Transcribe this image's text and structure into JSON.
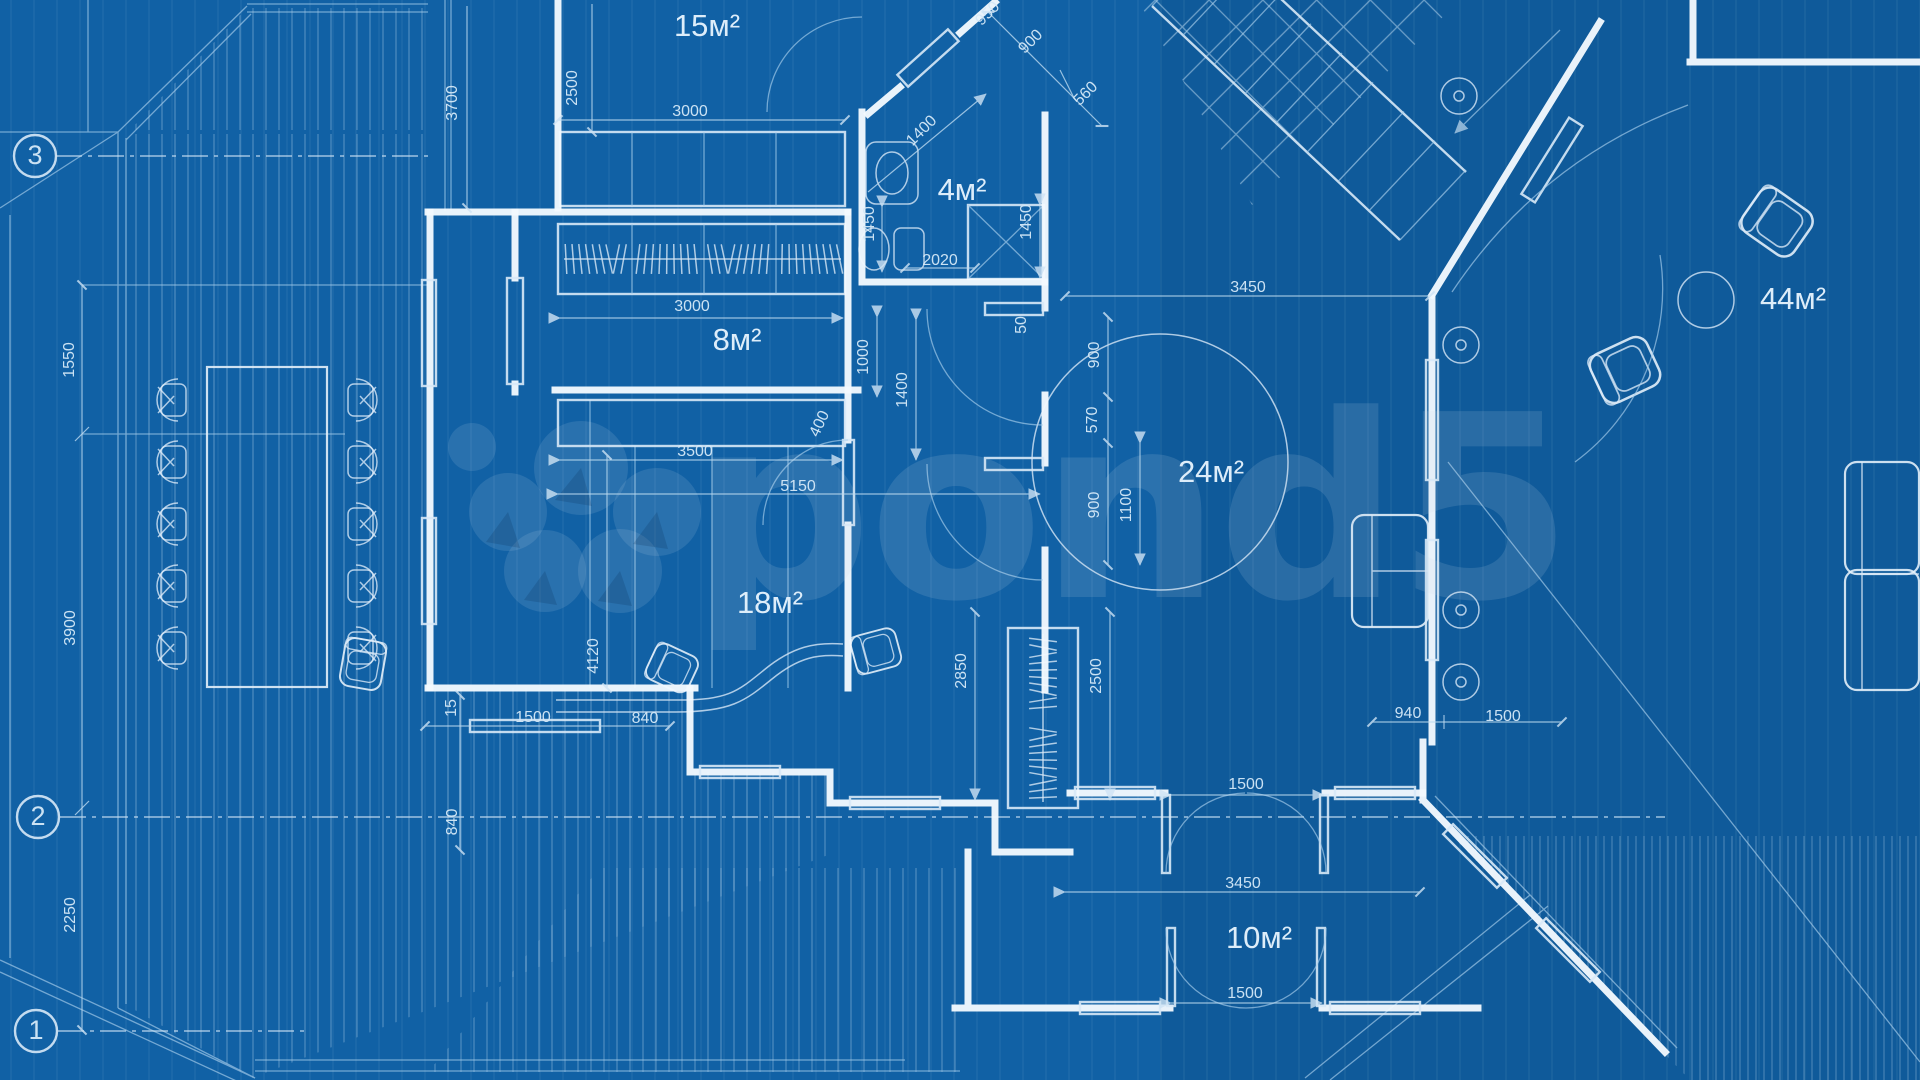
{
  "title": "Architecture blueprint floor plan",
  "colors": {
    "background": "#1161a5",
    "wall_lines": "#f3f9fe",
    "thin_lines": "#a9cfec",
    "labels": "#d5e9f8",
    "watermark": "rgba(208,222,236,0.14)"
  },
  "watermark": {
    "text": "pond5",
    "logo": "pond5-circles-logo"
  },
  "grid_markers": [
    {
      "label": "3",
      "x": 35,
      "y": 156
    },
    {
      "label": "2",
      "x": 38,
      "y": 817
    },
    {
      "label": "1",
      "x": 36,
      "y": 1031
    }
  ],
  "rooms": [
    {
      "label": "15м²",
      "x": 707,
      "y": 28
    },
    {
      "label": "4м²",
      "x": 962,
      "y": 192
    },
    {
      "label": "8м²",
      "x": 737,
      "y": 342
    },
    {
      "label": "24м²",
      "x": 1211,
      "y": 474
    },
    {
      "label": "18м²",
      "x": 770,
      "y": 605
    },
    {
      "label": "10м²",
      "x": 1259,
      "y": 940
    },
    {
      "label": "44м²",
      "x": 1793,
      "y": 301
    }
  ],
  "dimensions": [
    {
      "text": "2500",
      "x": 573,
      "y": 88,
      "rot": -90
    },
    {
      "text": "3700",
      "x": 453,
      "y": 103,
      "rot": -90
    },
    {
      "text": "3000",
      "x": 690,
      "y": 112,
      "rot": 0
    },
    {
      "text": "950",
      "x": 988,
      "y": 14,
      "rot": -45
    },
    {
      "text": "900",
      "x": 1031,
      "y": 42,
      "rot": -45
    },
    {
      "text": "560",
      "x": 1086,
      "y": 94,
      "rot": -45
    },
    {
      "text": "1400",
      "x": 922,
      "y": 131,
      "rot": -45
    },
    {
      "text": "1450",
      "x": 870,
      "y": 224,
      "rot": -90
    },
    {
      "text": "1450",
      "x": 1027,
      "y": 222,
      "rot": -90
    },
    {
      "text": "2020",
      "x": 940,
      "y": 261,
      "rot": 0
    },
    {
      "text": "3450",
      "x": 1248,
      "y": 288,
      "rot": 0
    },
    {
      "text": "3000",
      "x": 692,
      "y": 307,
      "rot": 0
    },
    {
      "text": "50",
      "x": 1022,
      "y": 325,
      "rot": -90
    },
    {
      "text": "1000",
      "x": 864,
      "y": 357,
      "rot": -90
    },
    {
      "text": "900",
      "x": 1095,
      "y": 355,
      "rot": -90
    },
    {
      "text": "1400",
      "x": 903,
      "y": 390,
      "rot": -90
    },
    {
      "text": "570",
      "x": 1093,
      "y": 420,
      "rot": -90
    },
    {
      "text": "400",
      "x": 820,
      "y": 424,
      "rot": -65
    },
    {
      "text": "3500",
      "x": 695,
      "y": 452,
      "rot": 0
    },
    {
      "text": "5150",
      "x": 798,
      "y": 487,
      "rot": 0
    },
    {
      "text": "900",
      "x": 1095,
      "y": 505,
      "rot": -90
    },
    {
      "text": "1100",
      "x": 1127,
      "y": 505,
      "rot": -90
    },
    {
      "text": "4120",
      "x": 594,
      "y": 656,
      "rot": -90
    },
    {
      "text": "2850",
      "x": 962,
      "y": 671,
      "rot": -90
    },
    {
      "text": "2500",
      "x": 1097,
      "y": 676,
      "rot": -90
    },
    {
      "text": "15",
      "x": 452,
      "y": 708,
      "rot": -90
    },
    {
      "text": "1500",
      "x": 533,
      "y": 718,
      "rot": 0
    },
    {
      "text": "840",
      "x": 645,
      "y": 719,
      "rot": 0
    },
    {
      "text": "840",
      "x": 453,
      "y": 822,
      "rot": -90
    },
    {
      "text": "940",
      "x": 1408,
      "y": 714,
      "rot": 0
    },
    {
      "text": "1500",
      "x": 1503,
      "y": 717,
      "rot": 0
    },
    {
      "text": "1500",
      "x": 1246,
      "y": 785,
      "rot": 0
    },
    {
      "text": "3450",
      "x": 1243,
      "y": 884,
      "rot": 0
    },
    {
      "text": "1500",
      "x": 1245,
      "y": 994,
      "rot": 0
    },
    {
      "text": "1550",
      "x": 70,
      "y": 360,
      "rot": -90
    },
    {
      "text": "3900",
      "x": 71,
      "y": 628,
      "rot": -90
    },
    {
      "text": "2250",
      "x": 71,
      "y": 915,
      "rot": -90
    }
  ]
}
